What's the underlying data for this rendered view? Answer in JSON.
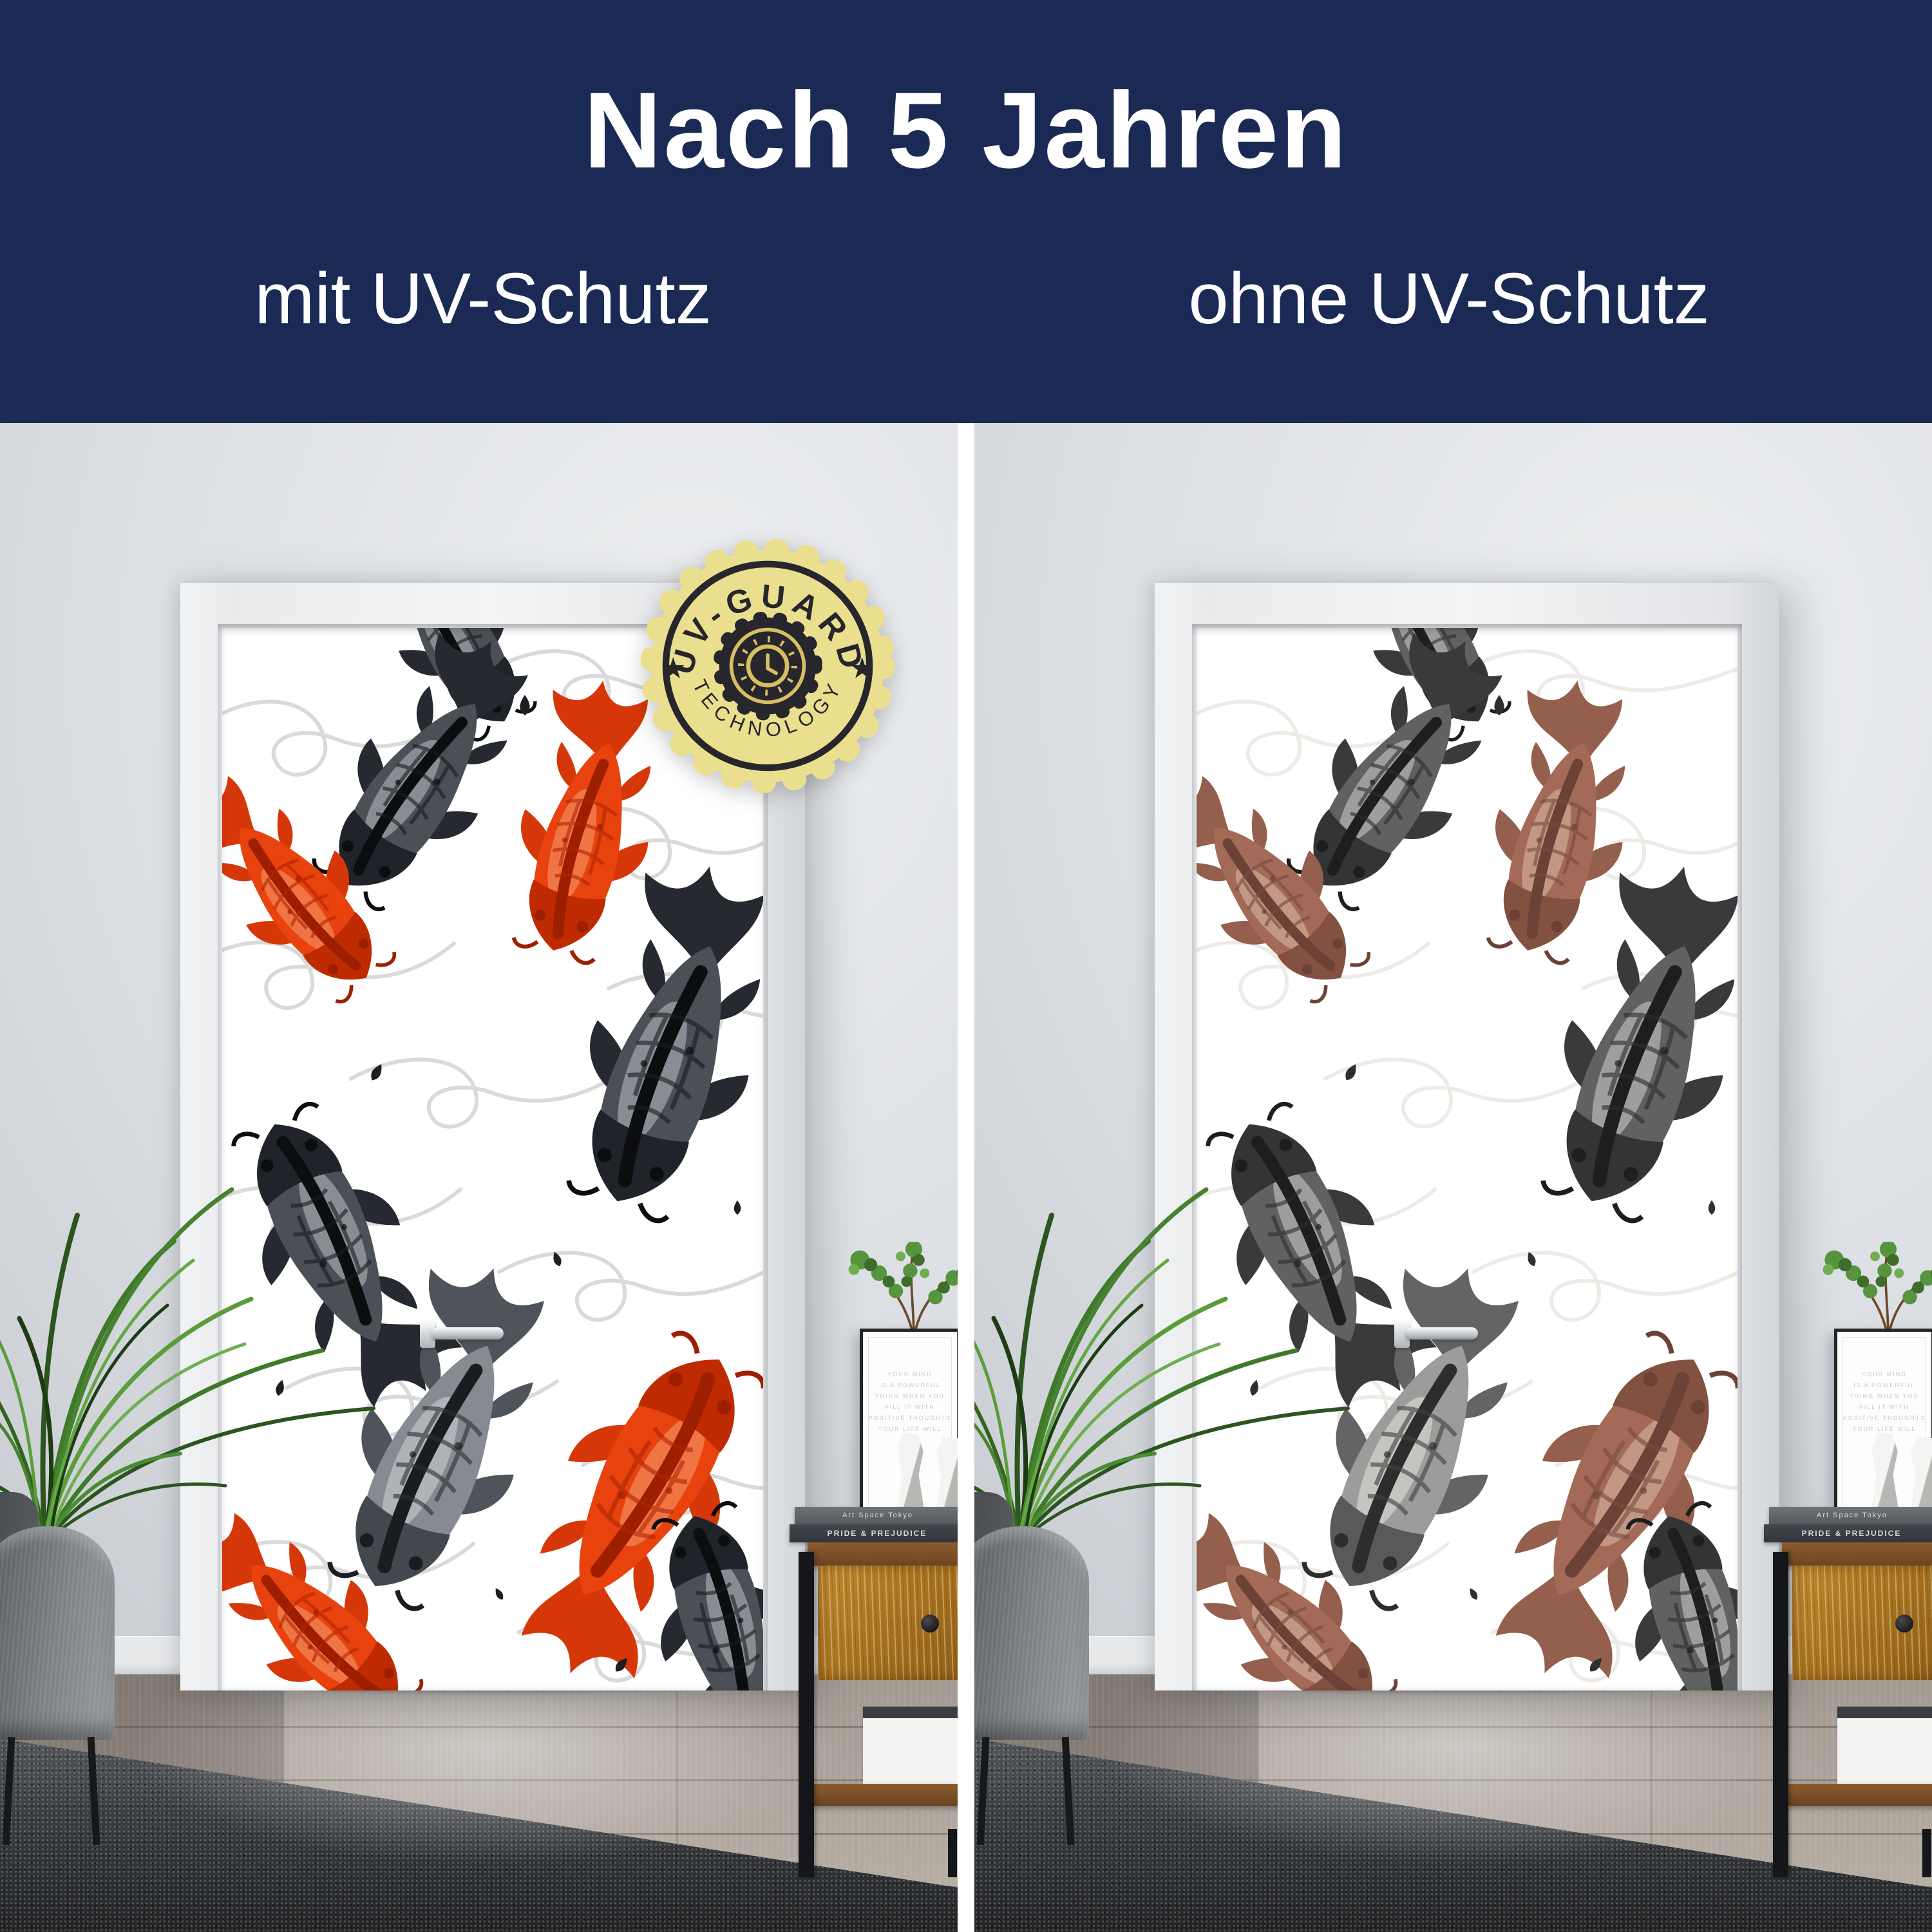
{
  "banner": {
    "title": "Nach 5 Jahren",
    "left_label": "mit UV-Schutz",
    "right_label": "ohne UV-Schutz",
    "background_color": "#1b2a55",
    "text_color": "#ffffff"
  },
  "badge": {
    "arc_top": "UV-GUARD",
    "arc_bottom": "TECHNOLOGY",
    "star_left": "★",
    "star_right": "★",
    "fill_color": "#eadf8e",
    "ink_color": "#26262c",
    "gold_color": "#d8be62",
    "center_icon": "clock-gear-icon"
  },
  "decor": {
    "book_top": "Art Space Tokyo",
    "book_bottom": "PRIDE & PREJUDICE",
    "quote_lines": [
      "YOUR MIND",
      "IS A POWERFUL",
      "THING WHEN YOU",
      "FILL IT WITH",
      "POSITIVE THOUGHTS",
      "YOUR LIFE WILL"
    ]
  },
  "mural_colors": {
    "koi_red_vivid": "#e8430e",
    "koi_red_faded": "#c57b63",
    "koi_dark": "#23262b",
    "koi_gray": "#858b91",
    "swirl_gray": "#dadada",
    "background": "#ffffff"
  }
}
